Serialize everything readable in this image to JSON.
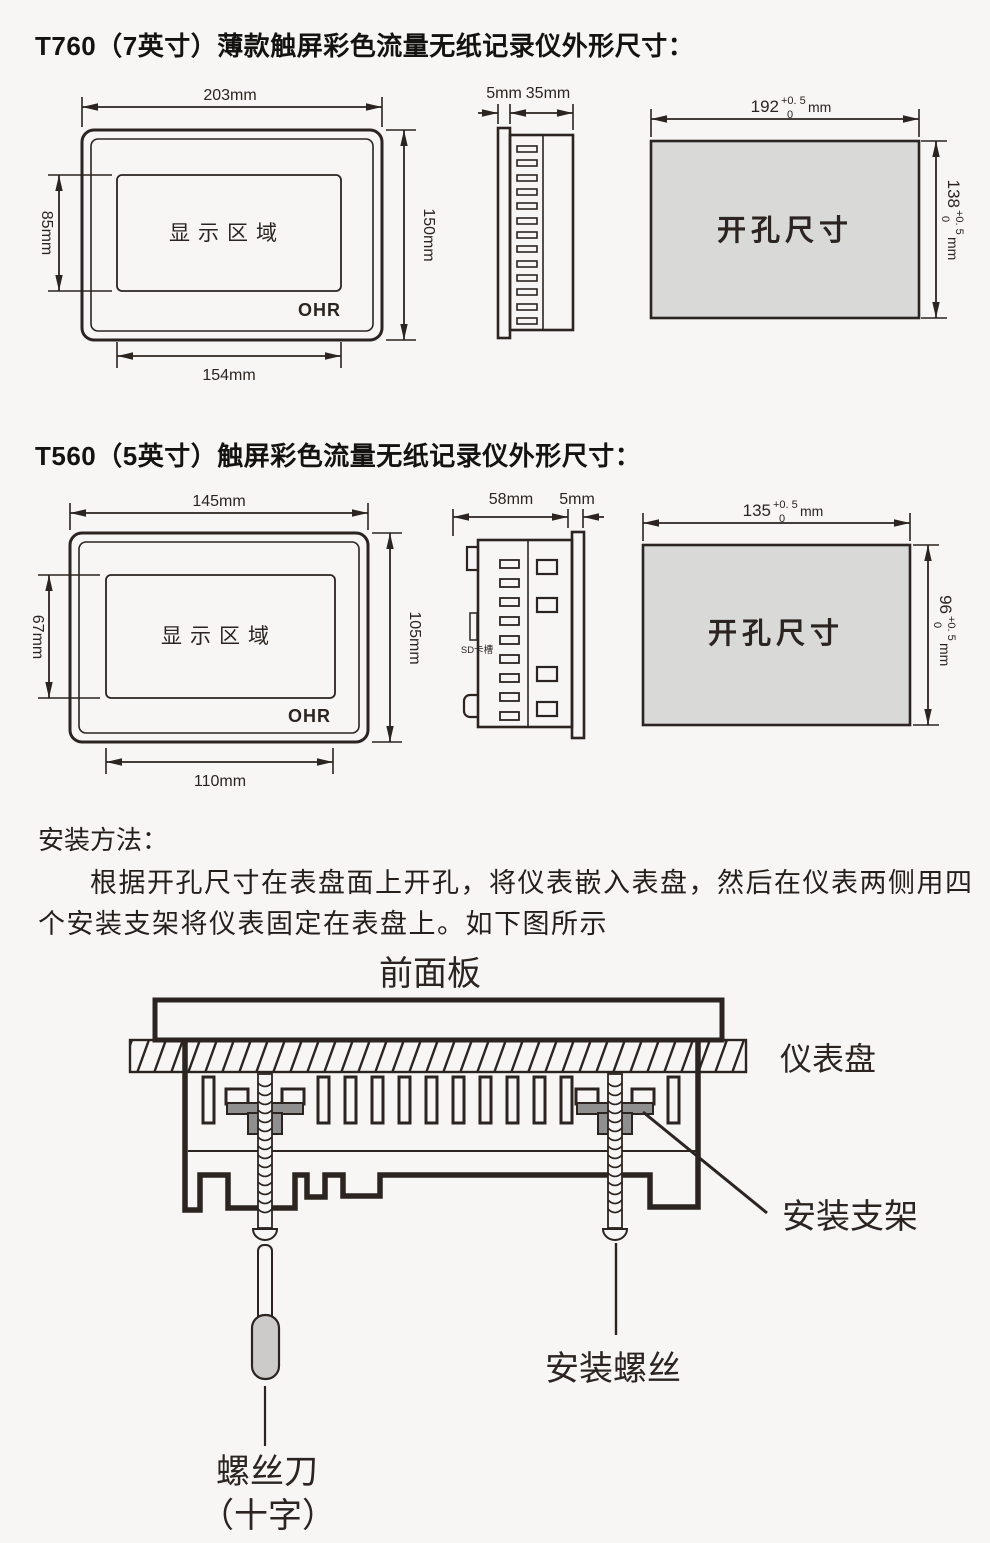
{
  "colors": {
    "line": "#2b2420",
    "cutout_fill": "#d9d9d8",
    "bracket_fill": "#8f8f8f",
    "handle_fill": "#cccbca",
    "background": "#f7f6f4"
  },
  "t760": {
    "title": "T760（7英寸）薄款触屏彩色流量无纸记录仪外形尺寸：",
    "front": {
      "width": "203mm",
      "display_height": "85mm",
      "height": "150mm",
      "display_width": "154mm",
      "display_label": "显示区域",
      "logo": "OHR"
    },
    "side": {
      "bezel": "5mm",
      "depth": "35mm"
    },
    "cutout": {
      "label": "开孔尺寸",
      "w": "192",
      "w_tol_up": "+0. 5",
      "w_tol_dn": "0",
      "w_unit": "mm",
      "h": "138",
      "h_tol_up": "+0. 5",
      "h_tol_dn": "0",
      "h_unit": "mm"
    }
  },
  "t560": {
    "title": "T560（5英寸）触屏彩色流量无纸记录仪外形尺寸：",
    "front": {
      "width": "145mm",
      "display_height": "67mm",
      "height": "105mm",
      "display_width": "110mm",
      "display_label": "显示区域",
      "logo": "OHR"
    },
    "side": {
      "depth": "58mm",
      "bezel": "5mm",
      "sd": "SD卡槽"
    },
    "cutout": {
      "label": "开孔尺寸",
      "w": "135",
      "w_tol_up": "+0. 5",
      "w_tol_dn": "0",
      "w_unit": "mm",
      "h": "96",
      "h_tol_up": "+0. 5",
      "h_tol_dn": "0",
      "h_unit": "mm"
    }
  },
  "install": {
    "heading": "安装方法：",
    "line1": "根据开孔尺寸在表盘面上开孔，将仪表嵌入表盘，然后在仪表两侧用四",
    "line2": "个安装支架将仪表固定在表盘上。如下图所示",
    "front_panel": "前面板",
    "instrument_panel": "仪表盘",
    "bracket": "安装支架",
    "screw": "安装螺丝",
    "screwdriver": "螺丝刀",
    "screwdriver_type": "（十字）"
  }
}
